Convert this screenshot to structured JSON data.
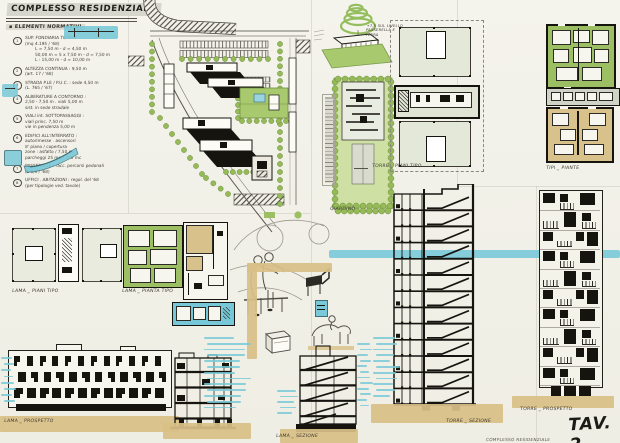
{
  "board": {
    "title": "COMPLESSO RESIDENZIALE",
    "plate_label": "TAV. 2",
    "footer_stamp": "COMPLESSO RESIDENZIALE"
  },
  "legend": {
    "heading": "ELEMENTI NORMATIVI",
    "notes": [
      {
        "num": "1",
        "lines": [
          "SUP. FONDIARIA TOTALE",
          "(mq 4.195 / '68)",
          "L = 7,50 m  -  d = 4,50 m",
          "50,00 m = 5 x 7,50 m  -  d = 7,50 m",
          "L : 15,00 m  -  d = 10,00 m"
        ]
      },
      {
        "num": "2",
        "lines": [
          "ALTEZZA CONTINUA : 9,50 m",
          "(art. 17 / '68)"
        ]
      },
      {
        "num": "3",
        "lines": [
          "STRADA P.LE / P.U.C. : sede 4,50 m",
          "(L. 765 / '67)"
        ]
      },
      {
        "num": "4",
        "lines": [
          "ALBERATURE A CONTORNO :",
          "2,50 - 7,50 m  .  viali 5,00 m",
          "sist. in sede stradale"
        ]
      },
      {
        "num": "5",
        "lines": [
          "VIALI int. SOTTOPASSAGGI :",
          "viali princ. 7,50 m",
          "vie in pendenza 5,00 m"
        ]
      },
      {
        "num": "6",
        "lines": [
          "EDIFICI ALL'INTERRATO :",
          "autorimesse . ascensori",
          "8' piano / copertura",
          "zone : asfalto / 7,50 m",
          "parcheggi 25 mq / 100 mc"
        ]
      },
      {
        "num": "7",
        "lines": [
          "PASSERELLE : racc. percorsi pedonali",
          "(L 6,5 / '68)"
        ]
      },
      {
        "num": "8",
        "lines": [
          "UFFICI . ABITAZIONI : regol. del '68",
          "(per tipologie ved. tavole)"
        ]
      }
    ]
  },
  "labels": {
    "torre_piani_tipo": "TORRE _ PIANI TIPO",
    "tipi_piante": "TIPI _ PIANTE",
    "lama_piani_tipo": "LAMA _ PIANI TIPO",
    "lama_pianta_tipo": "LAMA _ PIANTA TIPO",
    "giardino": "GIARDINO",
    "quota_nota": "+7,5 SUL LIVELLO PASSERELLA E TERRA",
    "lama_prospetto": "LAMA _ PROSPETTO",
    "lama_sezione": "LAMA _ SEZIONE",
    "torre_sezione": "TORRE _ SEZIONE",
    "torre_prospetto": "TORRE _ PROSPETTO"
  },
  "drawings": {
    "lama_elevation": {
      "floors": 3,
      "bays": 12
    },
    "torre_elevation": {
      "floors": 10,
      "bays": 3
    },
    "torre_section": {
      "floors": 13
    },
    "lama_section_a": {
      "floors": 4
    },
    "lama_section_b": {
      "floors": 5
    }
  },
  "colors": {
    "paper": "#f2f1e9",
    "ink": "#1c1b18",
    "green": "#9cbf63",
    "lawn": "#a9c96e",
    "cyan": "#76c8d8",
    "tan": "#d8bf86",
    "plan_fill": "#e4e8d9",
    "pool": "#9ad4e0"
  }
}
